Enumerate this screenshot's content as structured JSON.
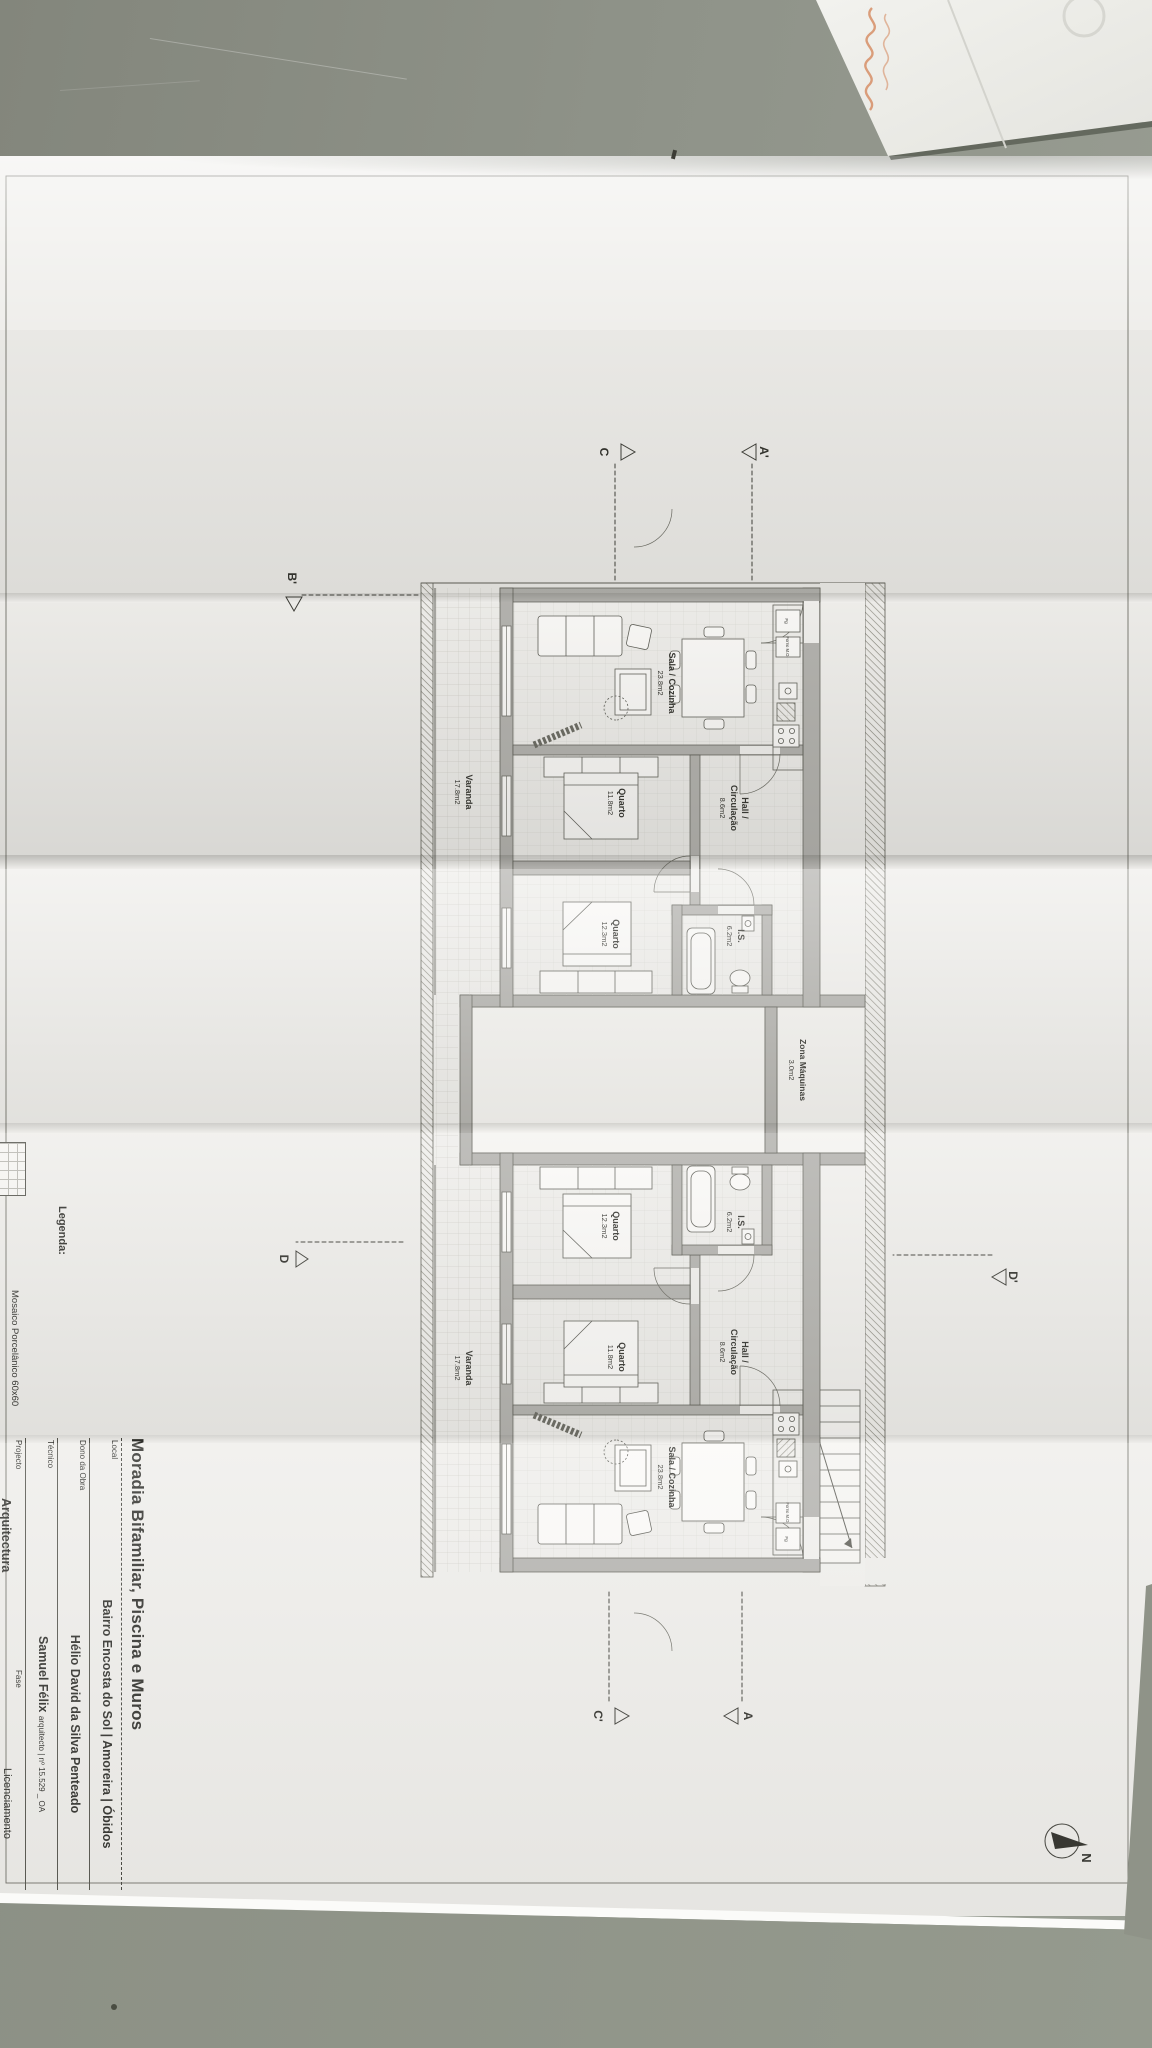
{
  "colors": {
    "desk": "#8f9389",
    "paper": "#efeeeb",
    "ink": "#4a4a45",
    "wall_fill": "#b3b2ae",
    "handwriting_orange": "#d68e66"
  },
  "sheet": {
    "north_label": "N",
    "title_block": {
      "title": "Moradia Bifamiliar, Piscina e Muros",
      "rows": [
        {
          "label": "Local",
          "value": "Bairro Encosta do Sol | Amoreira | Óbidos"
        },
        {
          "label": "Dono da Obra",
          "value": "Hélio David da Silva Penteado"
        },
        {
          "label": "Técnico",
          "value": "Samuel Félix",
          "value_detail": "arquitecto | nº 15.529 _ OA"
        },
        {
          "label": "Projecto",
          "value": "Arquitectura"
        },
        {
          "label": "Fase",
          "value": "Licenciamento"
        }
      ]
    },
    "legend": {
      "heading": "Legenda:",
      "item": "Mosaico Porcelânico 60x60"
    },
    "markers": {
      "c": "C",
      "a_prime": "A'",
      "c_prime": "C'",
      "a": "A",
      "b_prime": "B'",
      "d": "D",
      "d_prime": "D'"
    },
    "plan": {
      "kitchen": {
        "fridge": "Fg",
        "oven": "Forno M.O."
      },
      "zona_maquinas": {
        "name": "Zona Máquinas",
        "area": "3.0m2"
      },
      "dwellings": [
        {
          "rooms": {
            "sala": {
              "name": "Sala / Cozinha",
              "area": "23.8m2"
            },
            "hall": {
              "name": "Hall /",
              "name2": "Circulação",
              "area": "8.6m2"
            },
            "quarto1": {
              "name": "Quarto",
              "area": "11.8m2"
            },
            "quarto2": {
              "name": "Quarto",
              "area": "12.3m2"
            },
            "is": {
              "name": "I.S.",
              "area": "6.2m2"
            },
            "varanda": {
              "name": "Varanda",
              "area": "17.8m2"
            }
          }
        },
        {
          "rooms": {
            "sala": {
              "name": "Sala / Cozinha",
              "area": "23.8m2"
            },
            "hall": {
              "name": "Hall /",
              "name2": "Circulação",
              "area": "8.6m2"
            },
            "quarto1": {
              "name": "Quarto",
              "area": "11.8m2"
            },
            "quarto2": {
              "name": "Quarto",
              "area": "12.3m2"
            },
            "is": {
              "name": "I.S.",
              "area": "6.2m2"
            },
            "varanda": {
              "name": "Varanda",
              "area": "17.8m2"
            }
          }
        }
      ]
    }
  }
}
